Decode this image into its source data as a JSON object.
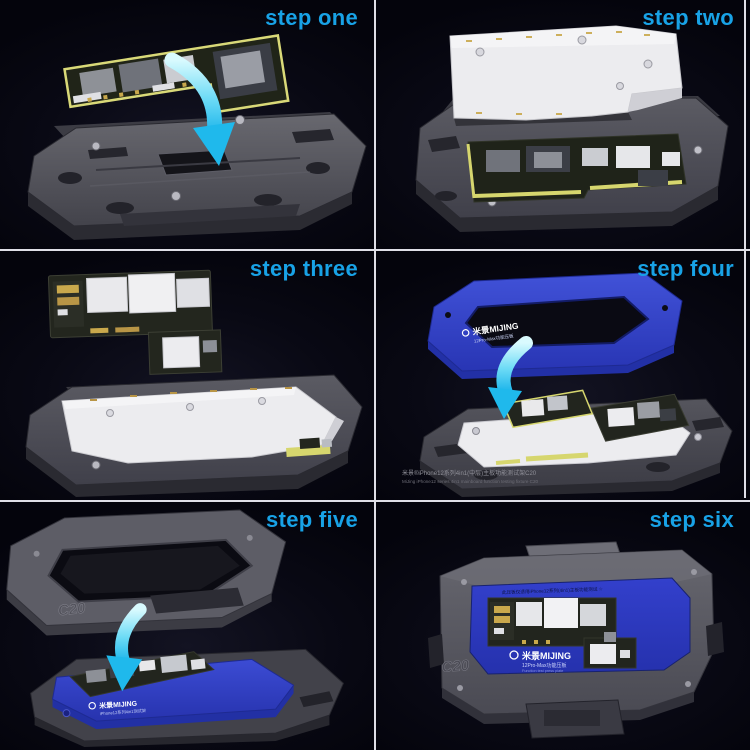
{
  "colors": {
    "accent_blue": "#18a2e6",
    "divider": "#dfdfe7",
    "background": "#06060f",
    "arrow_cyan": "#2ec4f0",
    "blue_part": "#3243cb",
    "gray_part": "#55555e",
    "white_plate": "#ececef",
    "pcb_green": "#22251e",
    "gasket_yellow": "#d6d66e"
  },
  "panels": [
    {
      "id": "one",
      "label": "step one"
    },
    {
      "id": "two",
      "label": "step two"
    },
    {
      "id": "three",
      "label": "step three"
    },
    {
      "id": "four",
      "label": "step four"
    },
    {
      "id": "five",
      "label": "step five"
    },
    {
      "id": "six",
      "label": "step six"
    }
  ],
  "texts": {
    "step4_frame_logo": "米景MIJING",
    "step4_frame_logo_sub": "12Pro-Max功能压板",
    "step4_watermark_cn": "米景®iPhone12系列4in1(中层)主板功能测试架C20",
    "step4_watermark_en": "MiJing iPhone12 series 4in1 mainboard function testing fixture C20",
    "step5_emboss": "C20",
    "step5_logo": "米景MIJING",
    "step5_logo_sub": "iPhone12系列4in1测试架",
    "step6_notice": "此压板仅适用iPhone12系列(4in1)主板功能测试 ☆",
    "step6_logo": "米景MIJING",
    "step6_model": "12Pro-Max功能压板",
    "step6_model_sub": "Function test press plate",
    "step6_emboss": "C20"
  }
}
